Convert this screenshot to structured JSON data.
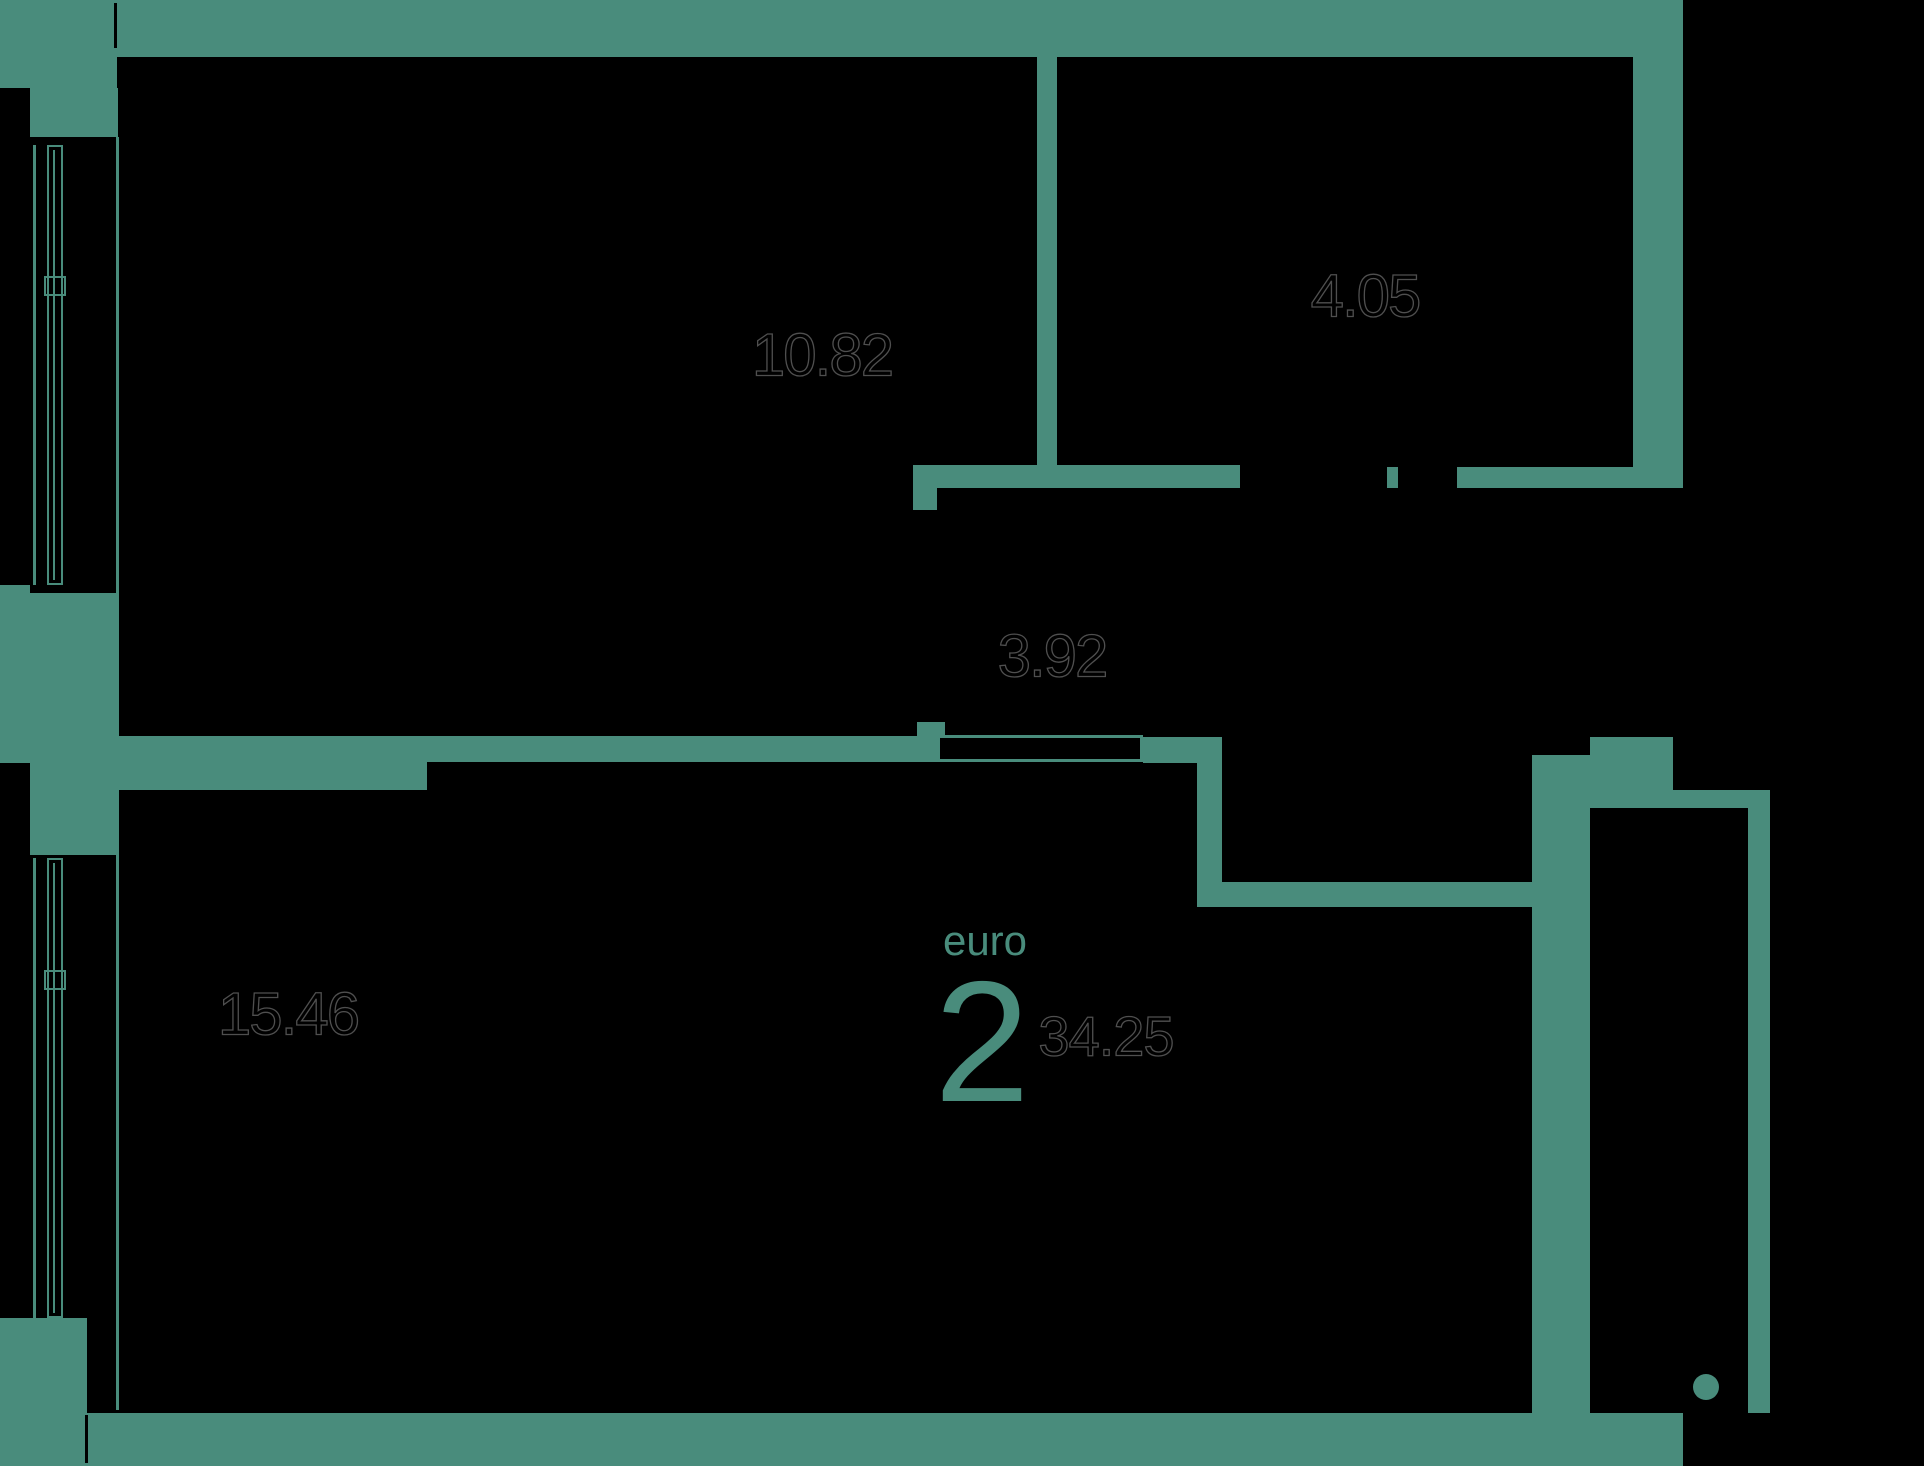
{
  "plan": {
    "unit": {
      "type_label": "euro",
      "rooms_count": "2",
      "total_area": "34.25"
    },
    "rooms": [
      {
        "name": "room-top",
        "area": "10.82"
      },
      {
        "name": "bathroom",
        "area": "4.05"
      },
      {
        "name": "hallway",
        "area": "3.92"
      },
      {
        "name": "room-bottom",
        "area": "15.46"
      }
    ],
    "colors": {
      "wall": "#498c7c",
      "background": "#000000",
      "area_text": "#000000",
      "area_text_outline": "#4f4f4f",
      "accent": "#498c7c"
    }
  }
}
